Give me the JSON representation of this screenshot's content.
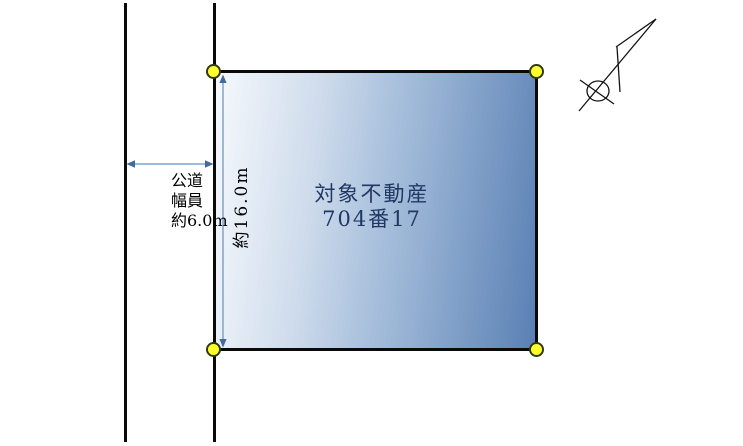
{
  "canvas": {
    "width": 743,
    "height": 446,
    "background": "#ffffff"
  },
  "road": {
    "labels": [
      "公道",
      "幅員",
      "約6.0m"
    ],
    "line_color": "#0a0a0a",
    "width_arrow_shaft_color": "#7fa3cf",
    "width_arrow_head_color": "#44699e"
  },
  "parcel": {
    "name_line1": "対象不動産",
    "name_line2": "704番17",
    "depth_label": "約16.0m",
    "text_color": "#1f3864",
    "border_color": "#0a0a0a",
    "gradient_start": "#f6f9fc",
    "gradient_end": "#5a80b4",
    "corner_marker_fill": "#ffff2e",
    "corner_marker_stroke": "#2f3a0e",
    "depth_arrow_shaft_color": "#7fa3cf",
    "depth_arrow_head_color": "#44699e"
  },
  "compass": {
    "icon": "north-arrow",
    "color": "#141414"
  }
}
